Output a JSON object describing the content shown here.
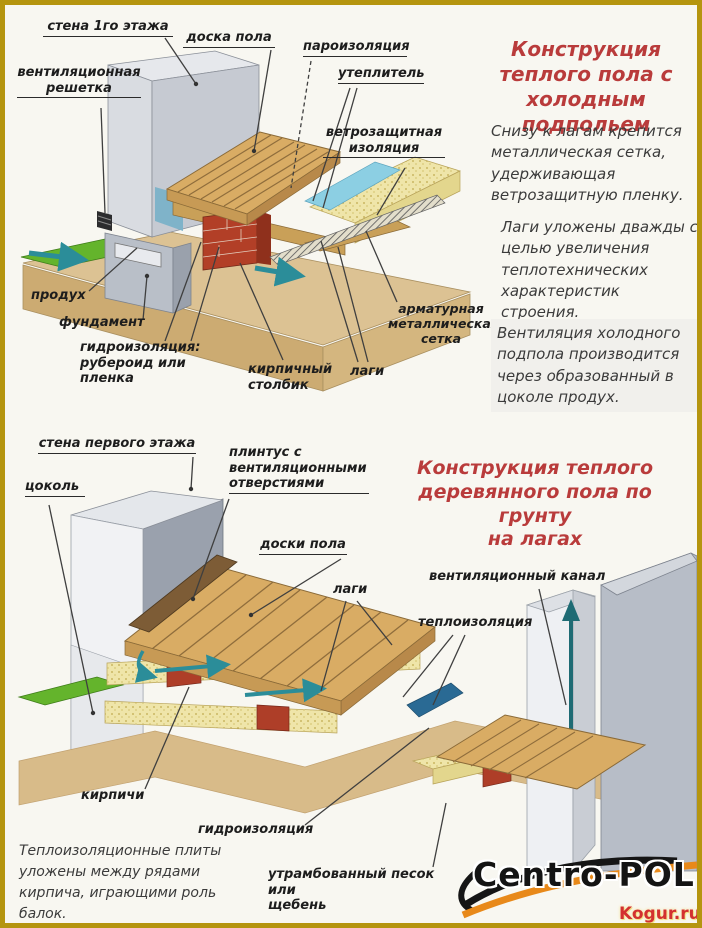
{
  "colors": {
    "border_gold": "#b5950f",
    "background": "#f8f7f1",
    "title_red": "#b93b3b",
    "label_black": "#1d1d1d",
    "wood": "#d9ac64",
    "insulation_yellow": "#efe5a9",
    "vapor_blue": "#8ccfe3",
    "hydro_dark_blue": "#2a6a94",
    "brick_red": "#ae3e28",
    "wall_gray": "#c6cad2",
    "grass_green": "#64b42c",
    "ground_tan": "#dcc293",
    "arrow_teal": "#2b8d99",
    "logo_orange": "#e8891a",
    "watermark_red": "#d33030"
  },
  "diagram1": {
    "title": "Конструкция\nтеплого пола с\nхолодным  подпольем",
    "labels": {
      "wall": "стена 1го этажа",
      "floor_board": "доска пола",
      "vapor_barrier": "пароизоляция",
      "insulation": "утеплитель",
      "wind_protection": "ветрозащитная\nизоляция",
      "vent_grille": "вентиляционная\nрешетка",
      "vent_opening": "продух",
      "foundation": "фундамент",
      "waterproofing": "гидроизоляция:\nрубероид или пленка",
      "brick_column": "кирпичный\nстолбик",
      "joists": "лаги",
      "rebar_mesh": "арматурная\nметаллическая\nсетка"
    },
    "paragraphs": [
      "Снизу к лагам крепится\nметаллическая сетка,\nудерживающая\nветрозащитную пленку.",
      "Лаги уложены дважды с\nцелью увеличения\nтеплотехнических\nхарактеристик строения.",
      "Вентиляция холодного\nподпола производится\nчерез образованный в\nцоколе продух."
    ]
  },
  "diagram2": {
    "title": "Конструкция теплого\nдеревянного пола по грунту\nна лагах",
    "labels": {
      "wall": "стена первого этажа",
      "plinth": "цоколь",
      "skirting": "плинтус с\nвентиляционными\nотверстиями",
      "floor_boards": "доски пола",
      "joists": "лаги",
      "vent_channel": "вентиляционный канал",
      "thermal_insulation": "теплоизоляция",
      "bricks": "кирпичи",
      "waterproofing": "гидроизоляция",
      "sand": "утрамбованный песок или\nщебень"
    },
    "note": "Теплоизоляционные плиты\nуложены между рядами\nкирпича, играющими роль\nбалок."
  },
  "footer": {
    "brand": "Centro-POL",
    "watermark": "Kogur.ru"
  }
}
